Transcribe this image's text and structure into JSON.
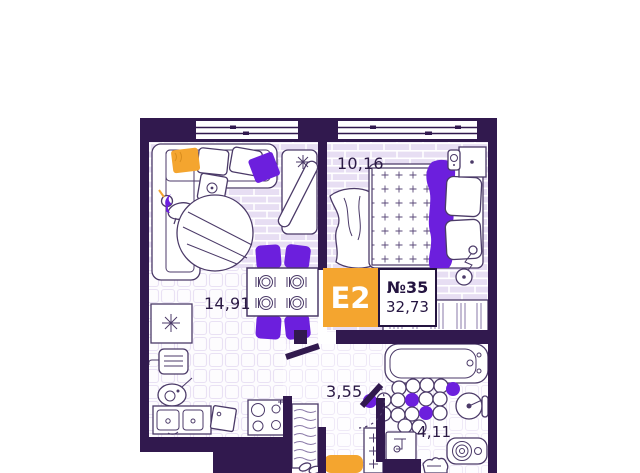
{
  "unit": {
    "type": "E2",
    "number": "№35",
    "total_area": "32,73"
  },
  "rooms": [
    {
      "id": "bedroom",
      "area": "10,16"
    },
    {
      "id": "living-kitchen",
      "area": "14,91"
    },
    {
      "id": "hallway",
      "area": "3,55"
    },
    {
      "id": "bathroom",
      "area": "4,11"
    }
  ],
  "colors": {
    "wall": "#31194e",
    "floor": "#e7def3",
    "floor_line": "#ffffff",
    "tile_line": "#e9e1f4",
    "outline": "#4b3a68",
    "accent_purple": "#6c1fdd",
    "accent_orange": "#f4a52f",
    "text": "#2b1a45",
    "background": "#ffffff"
  }
}
